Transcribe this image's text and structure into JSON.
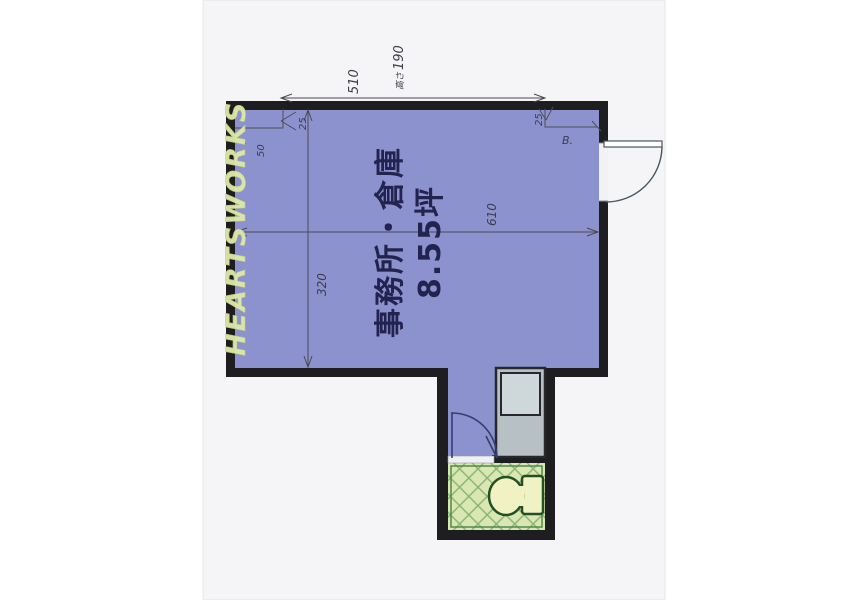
{
  "document": {
    "kind": "real-estate floor plan scan",
    "watermark": "HEARTSWORKS",
    "room": {
      "name": "事務所・倉庫",
      "area": "8.55坪"
    },
    "annotations": {
      "top_span": "510",
      "height_label": "高さ",
      "height_value": "190",
      "interior_width": "610",
      "interior_depth": "320",
      "corner_left_dim_a": "25",
      "corner_left_dim_b": "50",
      "corner_right_dim": "25",
      "door_note": "B."
    },
    "colors": {
      "room_fill": "#8C92CD",
      "wall": "#1E1E20",
      "paper": "#F5F5F7",
      "toilet_floor": "#DBE7B2",
      "toilet_lattice": "#86B373",
      "toilet_fixture_fill": "#F0F2C4",
      "toilet_outline": "#234F23",
      "gray_fixture": "#B7C0C4",
      "gray_fixture_inner": "#CED7D9",
      "watermark_color": "#E0EAAA",
      "printed_text": "#23234F"
    }
  }
}
